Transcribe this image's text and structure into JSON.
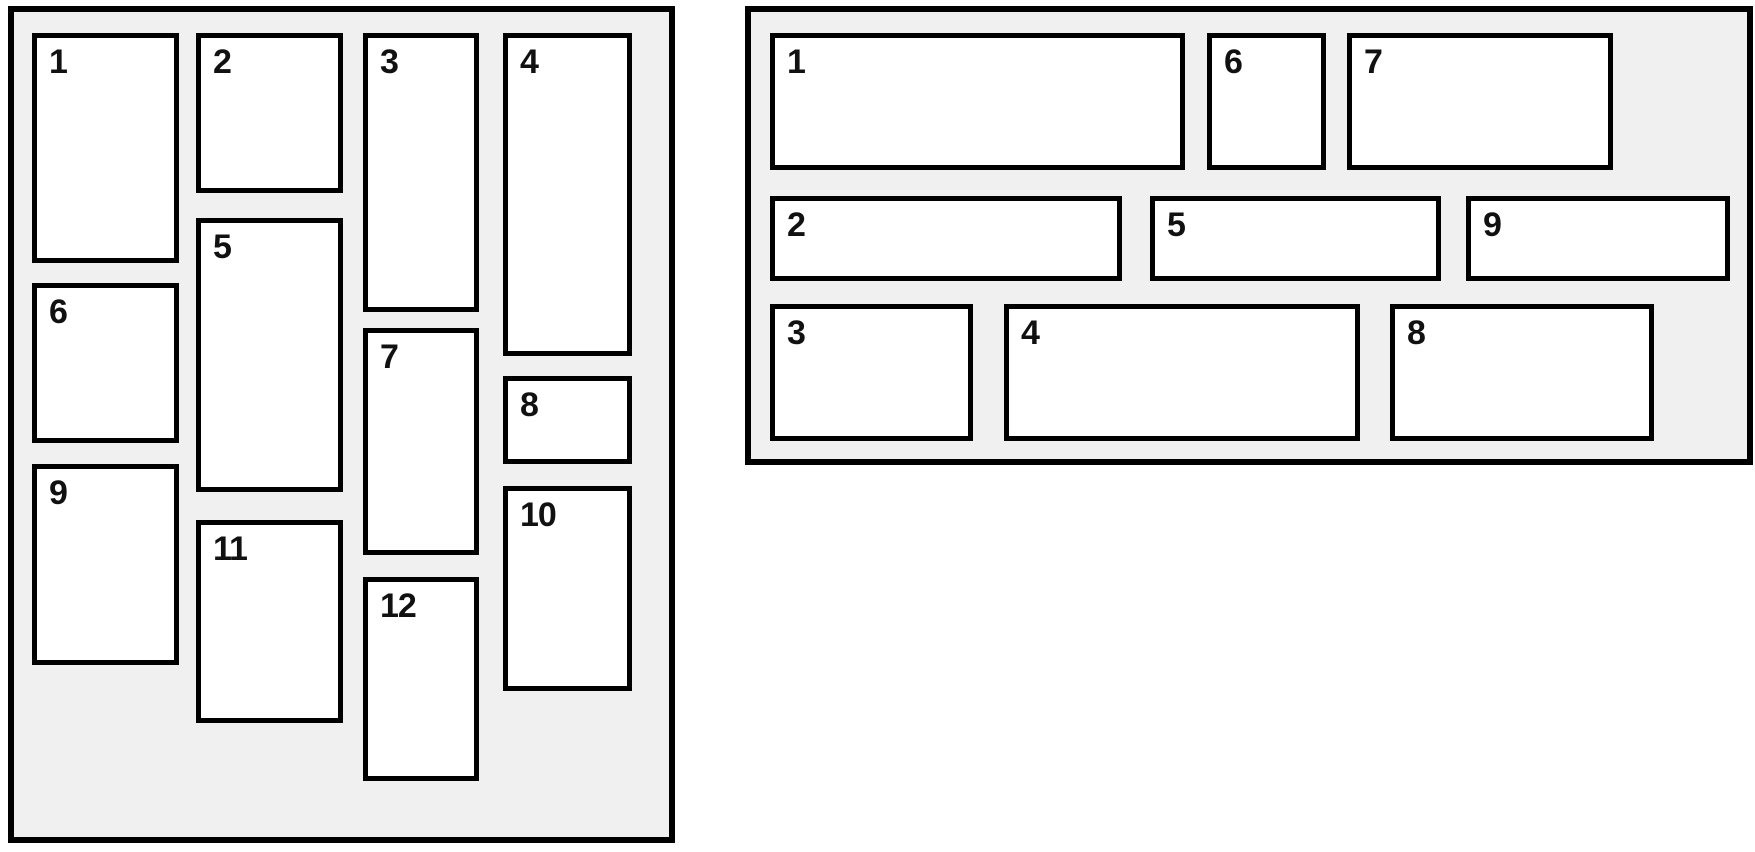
{
  "colors": {
    "page_background": "#ffffff",
    "panel_background": "#f0f0f0",
    "border": "#000000",
    "box_background": "#ffffff",
    "number_text": "#111111"
  },
  "panels": {
    "left": {
      "rect": {
        "x": 8,
        "y": 6,
        "w": 667,
        "h": 837
      },
      "items": [
        {
          "label": "1",
          "rect": {
            "x": 18,
            "y": 21,
            "w": 147,
            "h": 230
          }
        },
        {
          "label": "2",
          "rect": {
            "x": 182,
            "y": 21,
            "w": 147,
            "h": 160
          }
        },
        {
          "label": "3",
          "rect": {
            "x": 349,
            "y": 21,
            "w": 116,
            "h": 279
          }
        },
        {
          "label": "4",
          "rect": {
            "x": 489,
            "y": 21,
            "w": 129,
            "h": 323
          }
        },
        {
          "label": "5",
          "rect": {
            "x": 182,
            "y": 206,
            "w": 147,
            "h": 274
          }
        },
        {
          "label": "6",
          "rect": {
            "x": 18,
            "y": 271,
            "w": 147,
            "h": 160
          }
        },
        {
          "label": "7",
          "rect": {
            "x": 349,
            "y": 316,
            "w": 116,
            "h": 227
          }
        },
        {
          "label": "8",
          "rect": {
            "x": 489,
            "y": 364,
            "w": 129,
            "h": 88
          }
        },
        {
          "label": "9",
          "rect": {
            "x": 18,
            "y": 452,
            "w": 147,
            "h": 201
          }
        },
        {
          "label": "10",
          "rect": {
            "x": 489,
            "y": 474,
            "w": 129,
            "h": 205
          }
        },
        {
          "label": "11",
          "rect": {
            "x": 182,
            "y": 508,
            "w": 147,
            "h": 203
          }
        },
        {
          "label": "12",
          "rect": {
            "x": 349,
            "y": 565,
            "w": 116,
            "h": 204
          }
        }
      ]
    },
    "right": {
      "rect": {
        "x": 745,
        "y": 6,
        "w": 1008,
        "h": 459
      },
      "items": [
        {
          "label": "1",
          "rect": {
            "x": 19,
            "y": 21,
            "w": 415,
            "h": 137
          }
        },
        {
          "label": "2",
          "rect": {
            "x": 19,
            "y": 184,
            "w": 352,
            "h": 85
          }
        },
        {
          "label": "3",
          "rect": {
            "x": 19,
            "y": 292,
            "w": 203,
            "h": 137
          }
        },
        {
          "label": "4",
          "rect": {
            "x": 253,
            "y": 292,
            "w": 356,
            "h": 137
          }
        },
        {
          "label": "5",
          "rect": {
            "x": 399,
            "y": 184,
            "w": 291,
            "h": 85
          }
        },
        {
          "label": "6",
          "rect": {
            "x": 456,
            "y": 21,
            "w": 119,
            "h": 137
          }
        },
        {
          "label": "7",
          "rect": {
            "x": 596,
            "y": 21,
            "w": 266,
            "h": 137
          }
        },
        {
          "label": "8",
          "rect": {
            "x": 639,
            "y": 292,
            "w": 264,
            "h": 137
          }
        },
        {
          "label": "9",
          "rect": {
            "x": 715,
            "y": 184,
            "w": 264,
            "h": 85
          }
        }
      ]
    }
  }
}
